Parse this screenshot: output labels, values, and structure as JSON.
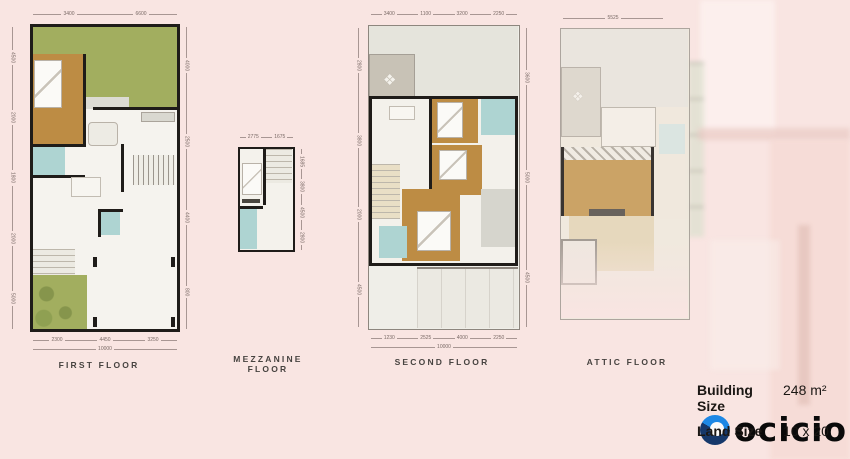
{
  "page": {
    "background_color": "#f9e5e2"
  },
  "plans": [
    {
      "label": "FIRST FLOOR",
      "dims": {
        "top": [
          "3400",
          "6600"
        ],
        "left": [
          "4500",
          "2000",
          "1800",
          "2000",
          "5000"
        ],
        "right": [
          "4000",
          "2500",
          "4400",
          "800"
        ],
        "bottom": [
          "2300",
          "4450",
          "3250"
        ],
        "bottom_total": [
          "10000"
        ]
      }
    },
    {
      "label": "MEZZANINE FLOOR",
      "dims": {
        "top": [
          "2775",
          "1675"
        ],
        "right": [
          "1685",
          "3800",
          "4500",
          "2800"
        ]
      }
    },
    {
      "label": "SECOND FLOOR",
      "dims": {
        "top": [
          "3400",
          "1100",
          "3200",
          "2250"
        ],
        "left": [
          "2800",
          "3800",
          "2000",
          "4500"
        ],
        "right": [
          "3600",
          "5000",
          "4500"
        ],
        "bottom": [
          "1230",
          "2525",
          "4000",
          "2250"
        ],
        "bottom_total": [
          "10000"
        ]
      }
    },
    {
      "label": "ATTIC FLOOR",
      "dims": {
        "top": [
          "5525"
        ]
      }
    }
  ],
  "info": {
    "rows": [
      {
        "label": "Building Size",
        "value": "248 m²"
      },
      {
        "label": "Land Size",
        "value": "10 x 20"
      }
    ]
  },
  "logo": {
    "text": "ocicio",
    "icon": "circle-swoosh-icon",
    "color_dark_blue": "#16386b",
    "color_light_blue": "#1e88e5",
    "text_color": "#0a0a0a"
  },
  "palette": {
    "background_pink": "#f9e5e2",
    "garden_green": "#a2ae5f",
    "wood_floor": "#bd8c44",
    "bath_teal": "#aed4d2",
    "wall_black": "#1f1c19",
    "roof_gray": "#e5e4dc"
  },
  "icons": {
    "balcony_table": "❖"
  }
}
